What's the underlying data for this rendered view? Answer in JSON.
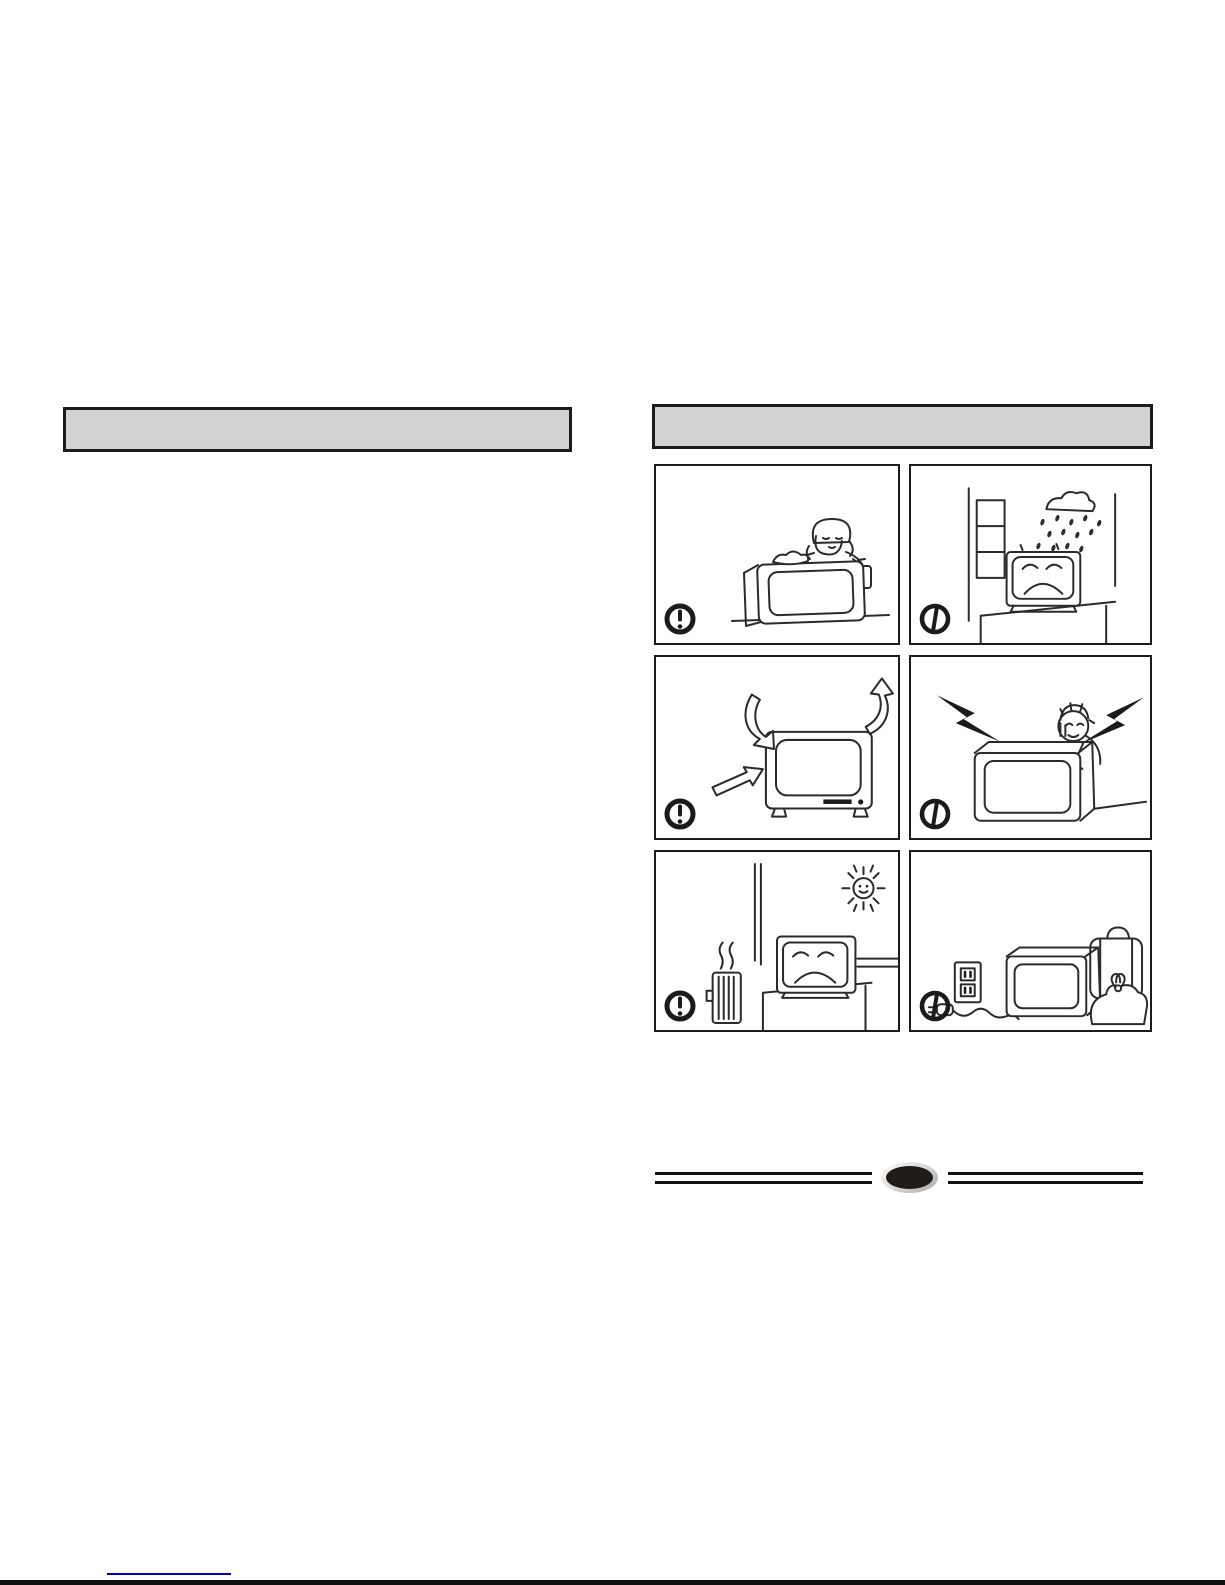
{
  "page": {
    "kind": "scanned-tv-manual-safety-page",
    "background": "#ffffff"
  },
  "colors": {
    "section_header_fill": "#d2d2d2",
    "section_header_border": "#1b1b1b",
    "panel_border": "#1b1b1b",
    "line_art": "#2b2b2b",
    "warning_icon": "#1b1b1b",
    "footer_badge_fill": "#211c18",
    "footer_badge_ring": "#c9c9c9",
    "link_underline": "#0000cc",
    "page_bottom_edge": "#101010"
  },
  "section_headers": {
    "left": {
      "label": ""
    },
    "right": {
      "label": ""
    }
  },
  "panels": [
    {
      "id": "wipe-clean-tv",
      "icon": "caution-exclamation-icon",
      "illustration": "person-wiping-tv-with-cloth-and-spray-bottle"
    },
    {
      "id": "rain-through-window",
      "icon": "prohibition-icon",
      "illustration": "sad-tv-getting-rained-on-by-open-window"
    },
    {
      "id": "ventilation-airflow",
      "icon": "caution-exclamation-icon",
      "illustration": "tv-with-airflow-arrows"
    },
    {
      "id": "electric-shock-back-cover",
      "icon": "prohibition-icon",
      "illustration": "person-opening-tv-back-with-lightning-bolts"
    },
    {
      "id": "heat-and-sunlight",
      "icon": "caution-exclamation-icon",
      "illustration": "sad-tv-near-sun-window-and-heater"
    },
    {
      "id": "unplug-when-away",
      "icon": "prohibition-icon",
      "illustration": "unplugged-tv-beside-travel-luggage"
    }
  ],
  "footer": {
    "page_badge_label": ""
  },
  "link": {
    "text": ""
  }
}
